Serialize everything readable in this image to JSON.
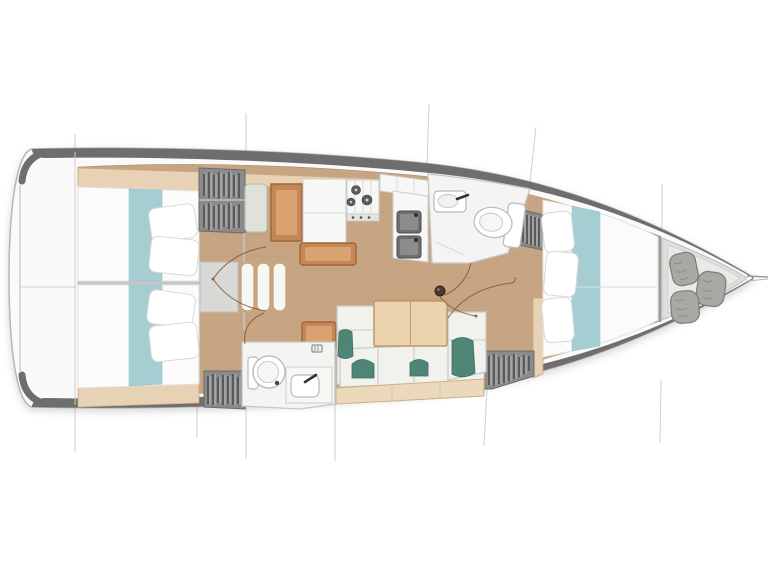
{
  "canvas": {
    "width": 768,
    "height": 576,
    "background": "#ffffff"
  },
  "colors": {
    "page_bg": "#ffffff",
    "hull_outline": "#b5b5b5",
    "deck_band": "#6e6e6e",
    "deck_white": "#fafafa",
    "floor_wood": "#c7a583",
    "trim_tan": "#e7d2b6",
    "trim_tan_border": "#c9a87e",
    "bedding_white": "#fbfbfb",
    "runner_teal": "#a5ced3",
    "pillow_white": "#ffffff",
    "wardrobe_gray": "#8b8b8b",
    "hanger_dark": "#4f4f4f",
    "cushion_white": "#f1f1ee",
    "cushion_seam": "#c9c9c5",
    "accent_pillow_teal": "#4f8576",
    "table_wood": "#ead3ae",
    "table_border": "#c19a67",
    "cabinet_caramel": "#c58757",
    "cabinet_caramel_light": "#d9a271",
    "cabinet_caramel_border": "#9e6636",
    "fixture_white": "#f7f7f6",
    "fixture_outline": "#b9b9b9",
    "sink_dark": "#6f6f6f",
    "burner_dark": "#5c5c5c",
    "head_floor": "#f4f4f2",
    "locker_floor": "#dededc",
    "sail_bag_gray": "#a8a8a4",
    "section_line": "#cfcfcf",
    "door_arc": "#8a5a35",
    "engine_gray": "#d8d8d6",
    "base_tan": "#ecd9bc",
    "mast_dark": "#4a3a2e"
  },
  "elements": {
    "type": "sailboat-interior-floor-plan",
    "orientation": "bow-right",
    "features": [
      "aft-cabin-port-double-berth",
      "aft-cabin-starboard-double-berth",
      "companionway-steps",
      "engine-box",
      "nav-seat",
      "chart-table",
      "galley-stove-three-burners",
      "galley-double-sink",
      "galley-counters",
      "forward-head-with-toilet-and-sink",
      "aft-head-with-toilet-and-sink",
      "u-shaped-salon-settee",
      "salon-table",
      "three-hanging-lockers",
      "forward-v-berth",
      "bow-sail-locker-with-three-bags",
      "mast-position",
      "hull-section-lines",
      "bowsprit"
    ]
  }
}
